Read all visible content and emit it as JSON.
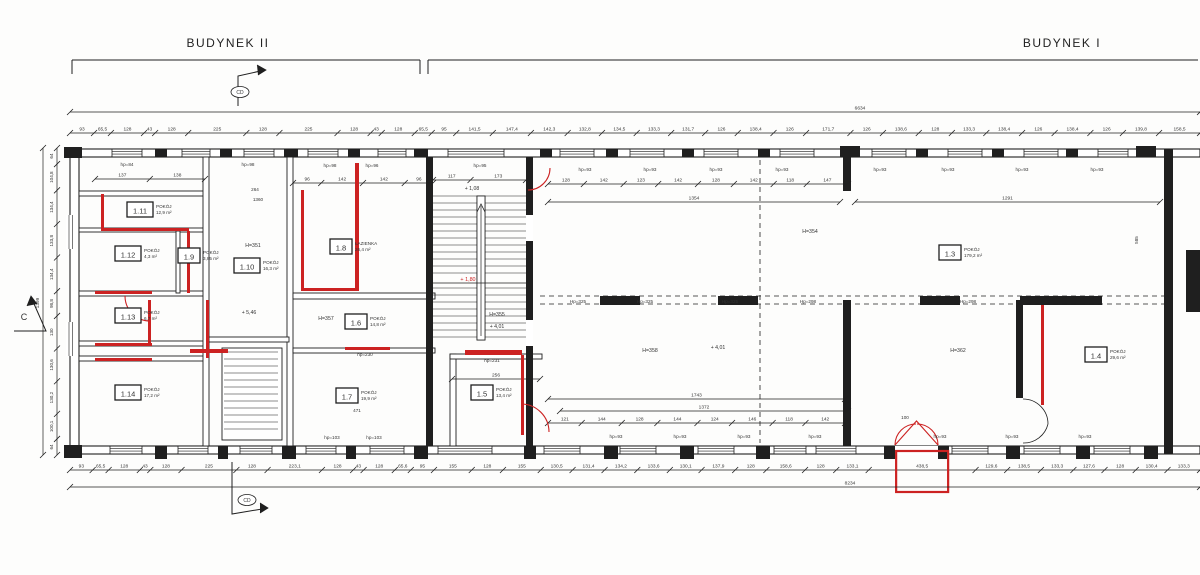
{
  "colors": {
    "line": "#1f1f1f",
    "red": "#cc2222",
    "bg": "#fdfdfc",
    "dim_text": "#333333"
  },
  "buildings": [
    {
      "label": "BUDYNEK II",
      "x0": 72,
      "x1": 420,
      "label_x": 228,
      "label_y": 47
    },
    {
      "label": "BUDYNEK I",
      "x0": 428,
      "x1": 1198,
      "label_x": 1062,
      "label_y": 47
    }
  ],
  "section_markers": [
    {
      "label": "CD",
      "cx": 240,
      "cy": 92,
      "poly": [
        [
          238,
          106
        ],
        [
          238,
          76
        ],
        [
          265,
          70
        ]
      ],
      "arrow": [
        [
          257,
          65
        ],
        [
          266,
          70
        ],
        [
          258,
          75
        ]
      ]
    },
    {
      "label": "CD",
      "cx": 247,
      "cy": 500,
      "poly": [
        [
          232,
          462
        ],
        [
          232,
          514
        ],
        [
          268,
          508
        ]
      ],
      "arrow": [
        [
          260,
          503
        ],
        [
          268,
          508
        ],
        [
          260,
          513
        ]
      ]
    },
    {
      "label": "C",
      "cx": 24,
      "cy": 320,
      "poly": [
        [
          14,
          331
        ],
        [
          46,
          331
        ],
        [
          31,
          297
        ]
      ],
      "arrow": [
        [
          27,
          306
        ],
        [
          31,
          296
        ],
        [
          37,
          304
        ]
      ]
    }
  ],
  "rooms": [
    {
      "id": "1.3",
      "name": "POKÓJ",
      "area": "179,2 m²",
      "x": 950,
      "y": 253
    },
    {
      "id": "1.4",
      "name": "POKÓJ",
      "area": "29,6 m²",
      "x": 1096,
      "y": 355
    },
    {
      "id": "1.5",
      "name": "POKÓJ",
      "area": "13,4 m²",
      "x": 482,
      "y": 393
    },
    {
      "id": "1.6",
      "name": "POKÓJ",
      "area": "14,8 m²",
      "x": 356,
      "y": 322
    },
    {
      "id": "1.7",
      "name": "POKÓJ",
      "area": "19,9 m²",
      "x": 347,
      "y": 396
    },
    {
      "id": "1.8",
      "name": "ŁAZIENKA",
      "area": "26,4 m²",
      "x": 341,
      "y": 247
    },
    {
      "id": "1.9",
      "name": "POKÓJ",
      "area": "3,85 m²",
      "x": 189,
      "y": 256
    },
    {
      "id": "1.10",
      "name": "POKÓJ",
      "area": "16,3 m²",
      "x": 247,
      "y": 266
    },
    {
      "id": "1.11",
      "name": "POKÓJ",
      "area": "12,9 m²",
      "x": 140,
      "y": 210
    },
    {
      "id": "1.12",
      "name": "POKÓJ",
      "area": "4,3 m²",
      "x": 128,
      "y": 254
    },
    {
      "id": "1.13",
      "name": "POKÓJ",
      "area": "6,7 m²",
      "x": 128,
      "y": 316
    },
    {
      "id": "1.14",
      "name": "POKÓJ",
      "area": "17,2 m²",
      "x": 128,
      "y": 393
    }
  ],
  "texts": [
    {
      "x": 253,
      "y": 247,
      "t": "H=351",
      "s": 5.2
    },
    {
      "x": 810,
      "y": 233,
      "t": "H=354",
      "s": 5.2
    },
    {
      "x": 497,
      "y": 316,
      "t": "H=355",
      "s": 5.2
    },
    {
      "x": 326,
      "y": 320,
      "t": "H=357",
      "s": 5.2
    },
    {
      "x": 650,
      "y": 352,
      "t": "H=358",
      "s": 5.2
    },
    {
      "x": 958,
      "y": 352,
      "t": "H=362",
      "s": 5.2
    },
    {
      "x": 472,
      "y": 190,
      "t": "+ 1,08",
      "s": 5.2
    },
    {
      "x": 497,
      "y": 328,
      "t": "+ 4,01",
      "s": 5.2
    },
    {
      "x": 718,
      "y": 349,
      "t": "+ 4,01",
      "s": 5.2
    },
    {
      "x": 249,
      "y": 314,
      "t": "+ 5,46",
      "s": 5.2
    },
    {
      "x": 468,
      "y": 281,
      "t": "+ 1,80",
      "s": 5.4,
      "c": "#cc2222"
    },
    {
      "x": 127,
      "y": 166,
      "t": "hp=84",
      "s": 4.6
    },
    {
      "x": 248,
      "y": 166,
      "t": "hp=98",
      "s": 4.6
    },
    {
      "x": 330,
      "y": 167,
      "t": "hp=98",
      "s": 4.6
    },
    {
      "x": 372,
      "y": 167,
      "t": "hp=96",
      "s": 4.6
    },
    {
      "x": 480,
      "y": 167,
      "t": "hp=95",
      "s": 4.6
    },
    {
      "x": 585,
      "y": 171,
      "t": "hp=93",
      "s": 4.6
    },
    {
      "x": 650,
      "y": 171,
      "t": "hp=93",
      "s": 4.6
    },
    {
      "x": 716,
      "y": 171,
      "t": "hp=93",
      "s": 4.6
    },
    {
      "x": 782,
      "y": 171,
      "t": "hp=93",
      "s": 4.6
    },
    {
      "x": 880,
      "y": 171,
      "t": "hp=93",
      "s": 4.6
    },
    {
      "x": 948,
      "y": 171,
      "t": "hp=93",
      "s": 4.6
    },
    {
      "x": 1022,
      "y": 171,
      "t": "hp=93",
      "s": 4.6
    },
    {
      "x": 1097,
      "y": 171,
      "t": "hp=93",
      "s": 4.6
    },
    {
      "x": 332,
      "y": 439,
      "t": "hp=103",
      "s": 4.6
    },
    {
      "x": 374,
      "y": 439,
      "t": "hp=103",
      "s": 4.6
    },
    {
      "x": 616,
      "y": 438,
      "t": "hp=93",
      "s": 4.6
    },
    {
      "x": 680,
      "y": 438,
      "t": "hp=93",
      "s": 4.6
    },
    {
      "x": 744,
      "y": 438,
      "t": "hp=93",
      "s": 4.6
    },
    {
      "x": 815,
      "y": 438,
      "t": "hp=93",
      "s": 4.6
    },
    {
      "x": 940,
      "y": 438,
      "t": "hp=93",
      "s": 4.6
    },
    {
      "x": 1012,
      "y": 438,
      "t": "hp=93",
      "s": 4.6
    },
    {
      "x": 1085,
      "y": 438,
      "t": "hp=93",
      "s": 4.6
    },
    {
      "x": 578,
      "y": 303,
      "t": "Hp=325",
      "s": 4.6
    },
    {
      "x": 645,
      "y": 303,
      "t": "Hp=325",
      "s": 4.6
    },
    {
      "x": 730,
      "y": 303,
      "t": "Hp=325",
      "s": 4.6
    },
    {
      "x": 808,
      "y": 303,
      "t": "Hp=298",
      "s": 4.6
    },
    {
      "x": 968,
      "y": 303,
      "t": "Hp=298",
      "s": 4.6
    },
    {
      "x": 365,
      "y": 356,
      "t": "hp=230",
      "s": 4.6
    },
    {
      "x": 492,
      "y": 362,
      "t": "hp=231",
      "s": 4.6
    },
    {
      "x": 255,
      "y": 191,
      "t": "264",
      "s": 4.6
    },
    {
      "x": 258,
      "y": 201,
      "t": "1360",
      "s": 4.6
    },
    {
      "x": 357,
      "y": 412,
      "t": "471",
      "s": 4.6
    },
    {
      "x": 905,
      "y": 419,
      "t": "100",
      "s": 4.6
    },
    {
      "x": 1138,
      "y": 240,
      "t": "585",
      "s": 4.6,
      "rot": -90
    }
  ],
  "dim_chains": [
    {
      "dir": "h",
      "x0": 70,
      "x1": 1200,
      "y": 133,
      "vals": [
        "93",
        "65,5",
        "128",
        "43",
        "128",
        "225",
        "128",
        "225",
        "128",
        "43",
        "128",
        "65,5",
        "95",
        "141,5",
        "147,4",
        "142,3",
        "132,8",
        "134,5",
        "133,3",
        "131,7",
        "126",
        "138,4",
        "126",
        "171,7",
        "126",
        "138,6",
        "128",
        "133,3",
        "138,4",
        "126",
        "138,4",
        "126",
        "139,8",
        "158,5"
      ]
    },
    {
      "dir": "h",
      "x0": 70,
      "x1": 1200,
      "y": 470,
      "highlight": "438,5",
      "vals": [
        "93",
        "65,5",
        "128",
        "43",
        "128",
        "225",
        "128",
        "223,1",
        "128",
        "43",
        "128",
        "65,6",
        "95",
        "155",
        "128",
        "155",
        "130,5",
        "131,4",
        "134,2",
        "133,6",
        "130,1",
        "137,9",
        "128",
        "158,6",
        "128",
        "133,1",
        "438,5",
        "129,6",
        "138,5",
        "133,3",
        "127,6",
        "128",
        "130,4",
        "133,3"
      ]
    },
    {
      "dir": "h",
      "x0": 95,
      "x1": 205,
      "y": 179,
      "vals": [
        "137",
        "138"
      ]
    },
    {
      "dir": "h",
      "x0": 293,
      "x1": 433,
      "y": 183,
      "vals": [
        "96",
        "142",
        "142",
        "96"
      ]
    },
    {
      "dir": "h",
      "x0": 433,
      "x1": 526,
      "y": 180,
      "vals": [
        "117",
        "173"
      ]
    },
    {
      "dir": "h",
      "x0": 548,
      "x1": 848,
      "y": 184,
      "vals": [
        "128",
        "142",
        "123",
        "142",
        "128",
        "142",
        "118",
        "147"
      ]
    },
    {
      "dir": "h",
      "x0": 548,
      "x1": 840,
      "y": 202,
      "vals": [
        "1354"
      ]
    },
    {
      "dir": "h",
      "x0": 855,
      "x1": 1160,
      "y": 202,
      "vals": [
        "1291"
      ]
    },
    {
      "dir": "h",
      "x0": 548,
      "x1": 845,
      "y": 399,
      "vals": [
        "1743"
      ]
    },
    {
      "dir": "h",
      "x0": 560,
      "x1": 848,
      "y": 411,
      "vals": [
        "1372"
      ]
    },
    {
      "dir": "h",
      "x0": 548,
      "x1": 845,
      "y": 423,
      "vals": [
        "121",
        "144",
        "128",
        "144",
        "124",
        "146",
        "118",
        "142"
      ]
    },
    {
      "dir": "h",
      "x0": 452,
      "x1": 540,
      "y": 379,
      "vals": [
        "256"
      ]
    },
    {
      "dir": "v",
      "x": 57,
      "y0": 148,
      "y1": 455,
      "vals": [
        "64",
        "104,8",
        "134,4",
        "133,8",
        "134,4",
        "98,8",
        "130",
        "130,6",
        "130,2",
        "100,1",
        "64"
      ]
    }
  ],
  "overall_dims": [
    {
      "dir": "h",
      "x0": 70,
      "x1": 1200,
      "y": 112,
      "label": "6634",
      "label_x": 860
    },
    {
      "dir": "h",
      "x0": 70,
      "x1": 1200,
      "y": 487,
      "label": "8234",
      "label_x": 850
    },
    {
      "dir": "v",
      "x": 43,
      "y0": 148,
      "y1": 455,
      "label": "1399",
      "label_y": 303
    }
  ],
  "plan": {
    "bands": [
      [
        70,
        149,
        1130,
        8
      ],
      [
        70,
        446,
        1130,
        8
      ],
      [
        70,
        149,
        9,
        305
      ]
    ],
    "piers": [
      [
        64,
        147,
        18,
        11
      ],
      [
        155,
        149,
        12,
        8
      ],
      [
        220,
        149,
        12,
        8
      ],
      [
        284,
        149,
        14,
        8
      ],
      [
        348,
        149,
        12,
        8
      ],
      [
        414,
        149,
        14,
        8
      ],
      [
        540,
        149,
        12,
        8
      ],
      [
        606,
        149,
        12,
        8
      ],
      [
        682,
        149,
        12,
        8
      ],
      [
        758,
        149,
        12,
        8
      ],
      [
        840,
        146,
        20,
        11
      ],
      [
        916,
        149,
        12,
        8
      ],
      [
        992,
        149,
        12,
        8
      ],
      [
        1066,
        149,
        12,
        8
      ],
      [
        1136,
        146,
        20,
        11
      ],
      [
        64,
        445,
        18,
        13
      ],
      [
        155,
        446,
        12,
        13
      ],
      [
        218,
        446,
        10,
        13
      ],
      [
        282,
        446,
        14,
        13
      ],
      [
        346,
        446,
        10,
        13
      ],
      [
        414,
        446,
        14,
        13
      ],
      [
        524,
        446,
        12,
        13
      ],
      [
        604,
        446,
        14,
        13
      ],
      [
        680,
        446,
        14,
        13
      ],
      [
        756,
        446,
        14,
        13
      ],
      [
        884,
        446,
        11,
        13
      ],
      [
        938,
        446,
        11,
        13
      ],
      [
        1006,
        446,
        14,
        13
      ],
      [
        1076,
        446,
        14,
        13
      ],
      [
        1144,
        446,
        14,
        13
      ]
    ],
    "windows_h": [
      [
        112,
        149.5,
        30
      ],
      [
        182,
        149.5,
        28
      ],
      [
        244,
        149.5,
        30
      ],
      [
        308,
        149.5,
        30
      ],
      [
        378,
        149.5,
        28
      ],
      [
        448,
        149.5,
        56
      ],
      [
        560,
        149.5,
        34
      ],
      [
        630,
        149.5,
        34
      ],
      [
        704,
        149.5,
        34
      ],
      [
        780,
        149.5,
        34
      ],
      [
        872,
        149.5,
        34
      ],
      [
        948,
        149.5,
        34
      ],
      [
        1024,
        149.5,
        34
      ],
      [
        1098,
        149.5,
        30
      ],
      [
        110,
        446.5,
        32
      ],
      [
        178,
        446.5,
        30
      ],
      [
        240,
        446.5,
        32
      ],
      [
        306,
        446.5,
        30
      ],
      [
        370,
        446.5,
        34
      ],
      [
        438,
        446.5,
        54
      ],
      [
        544,
        446.5,
        36
      ],
      [
        620,
        446.5,
        36
      ],
      [
        698,
        446.5,
        36
      ],
      [
        774,
        446.5,
        32
      ],
      [
        816,
        446.5,
        40
      ],
      [
        952,
        446.5,
        36
      ],
      [
        1024,
        446.5,
        36
      ],
      [
        1094,
        446.5,
        36
      ]
    ],
    "windows_v": [
      [
        66,
        215,
        12,
        34
      ],
      [
        66,
        322,
        12,
        34
      ]
    ],
    "door_gaps_white": [
      [
        895,
        446,
        43,
        9
      ],
      [
        204,
        262,
        4,
        22
      ],
      [
        204,
        306,
        4,
        22
      ],
      [
        204,
        396,
        4,
        22
      ],
      [
        288,
        250,
        4,
        22
      ],
      [
        288,
        380,
        4,
        22
      ],
      [
        526,
        215,
        7,
        26
      ],
      [
        526,
        320,
        7,
        26
      ]
    ],
    "hollow_walls": [
      [
        79,
        191,
        127,
        5
      ],
      [
        79,
        228,
        127,
        4
      ],
      [
        79,
        291,
        127,
        5
      ],
      [
        79,
        341,
        127,
        5
      ],
      [
        79,
        356,
        127,
        5
      ],
      [
        203,
        157,
        6,
        289
      ],
      [
        287,
        157,
        6,
        289
      ],
      [
        176,
        231,
        4,
        62
      ],
      [
        209,
        337,
        80,
        5
      ],
      [
        293,
        293,
        142,
        6
      ],
      [
        293,
        348,
        142,
        5
      ],
      [
        450,
        354,
        6,
        92
      ],
      [
        450,
        354,
        92,
        5
      ],
      [
        222,
        348,
        60,
        92
      ],
      [
        477,
        196,
        8,
        144
      ]
    ],
    "solid_walls": [
      [
        426,
        157,
        7,
        289
      ],
      [
        526,
        157,
        7,
        289
      ],
      [
        843,
        157,
        8,
        34
      ],
      [
        843,
        300,
        8,
        146
      ],
      [
        1016,
        300,
        7,
        98
      ],
      [
        1020,
        296,
        82,
        9
      ],
      [
        1164,
        149,
        9,
        305
      ],
      [
        1186,
        250,
        14,
        62
      ],
      [
        600,
        296,
        40,
        9
      ],
      [
        718,
        296,
        40,
        9
      ],
      [
        920,
        296,
        40,
        9
      ]
    ],
    "dashed_lines": [
      [
        760,
        160,
        760,
        443
      ],
      [
        540,
        296,
        1164,
        296
      ],
      [
        540,
        304,
        1164,
        304
      ]
    ],
    "thin_lines": [
      [
        433,
        283,
        526,
        283
      ],
      [
        481,
        336,
        481,
        206
      ]
    ],
    "arrow_polys": [
      [
        [
          477,
          212
        ],
        [
          481,
          204
        ],
        [
          485,
          212
        ]
      ]
    ],
    "black_paths": [
      "M1023,399 A25,25 0 0 1 1048,424",
      "M1023,443 A25,25 0 0 0 1048,424"
    ],
    "stairs": [
      {
        "x": 433,
        "y": 196,
        "w": 93,
        "rows": 12,
        "step": 7
      },
      {
        "x": 433,
        "y": 288,
        "w": 93,
        "rows": 8,
        "step": 7
      },
      {
        "x": 224,
        "y": 352,
        "w": 54,
        "rows": 12,
        "step": 7
      }
    ],
    "red_walls": [
      [
        101,
        194,
        3,
        36
      ],
      [
        101,
        228,
        88,
        3
      ],
      [
        187,
        231,
        3,
        62
      ],
      [
        95,
        291,
        57,
        3
      ],
      [
        148,
        300,
        3,
        43
      ],
      [
        95,
        343,
        57,
        3
      ],
      [
        95,
        358,
        57,
        3
      ],
      [
        206,
        300,
        3,
        58
      ],
      [
        301,
        190,
        3,
        100
      ],
      [
        355,
        163,
        4,
        128
      ],
      [
        301,
        288,
        58,
        3
      ],
      [
        190,
        349,
        38,
        4
      ],
      [
        345,
        347,
        45,
        3
      ],
      [
        465,
        350,
        57,
        5
      ],
      [
        521,
        355,
        3,
        80
      ],
      [
        1041,
        305,
        3,
        100
      ]
    ],
    "red_paths": [
      "M550,168 A22,22 0 0 1 528,190",
      "M150,321 A25,25 0 0 1 125,296",
      "M521,404 A28,28 0 0 1 549,432",
      "M895,445 A21,21 0 0 1 916,424",
      "M938,445 A21,21 0 0 0 917,424"
    ],
    "red_polys": [
      [
        [
          895,
          445
        ],
        [
          916.5,
          421
        ],
        [
          938,
          445
        ]
      ]
    ]
  }
}
